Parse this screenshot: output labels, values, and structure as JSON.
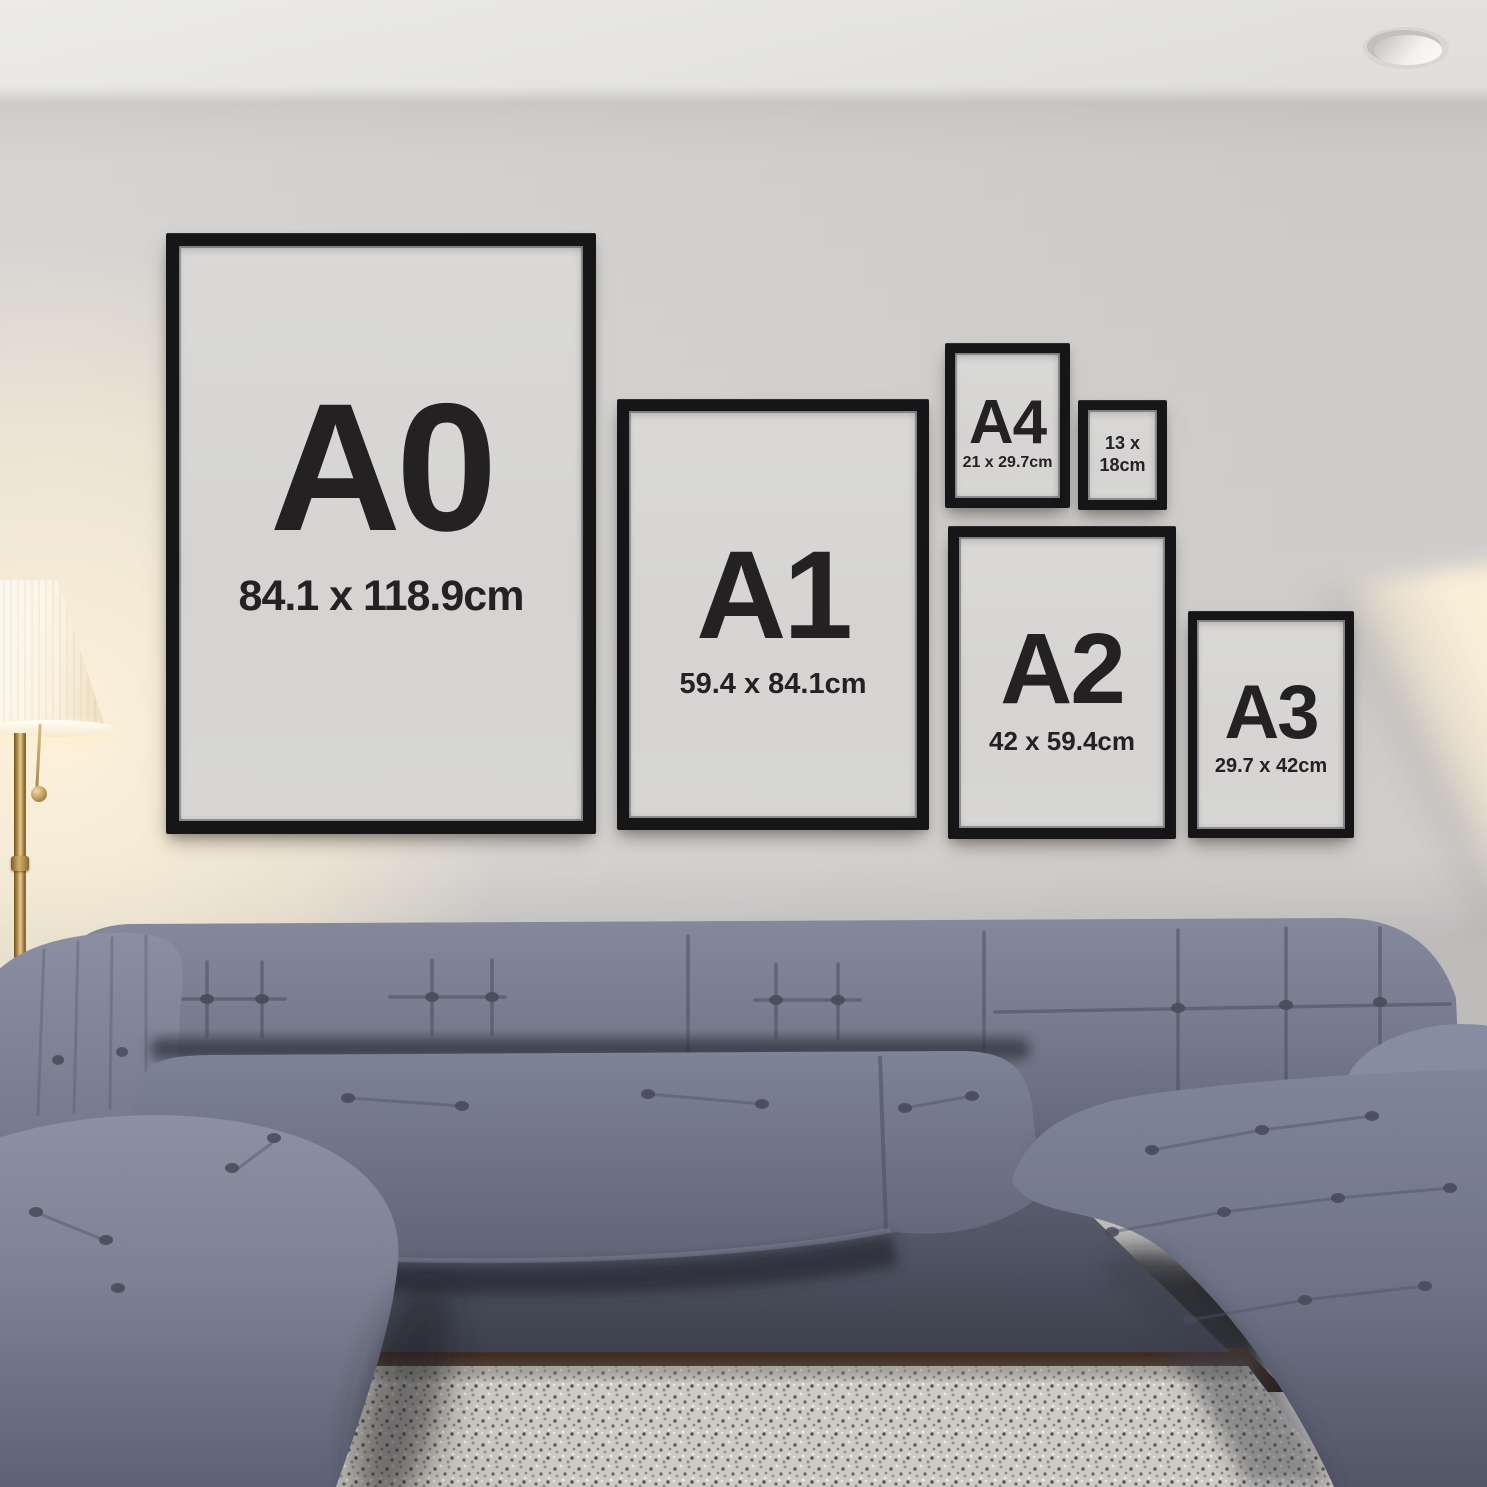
{
  "frames": [
    {
      "id": "a0",
      "label": "A0",
      "dimensions": "84.1 x 118.9cm"
    },
    {
      "id": "a1",
      "label": "A1",
      "dimensions": "59.4 x 84.1cm"
    },
    {
      "id": "a4",
      "label": "A4",
      "dimensions": "21 x 29.7cm"
    },
    {
      "id": "13x18",
      "dimensions_line1": "13 x",
      "dimensions_line2": "18cm"
    },
    {
      "id": "a2",
      "label": "A2",
      "dimensions": "42 x 59.4cm"
    },
    {
      "id": "a3",
      "label": "A3",
      "dimensions": "29.7 x 42cm"
    }
  ],
  "colors": {
    "frame_black": "#161618",
    "poster_paper": "#d7d6d4",
    "label_text": "#232122",
    "wall": "#d6d4d2",
    "ceiling": "#ebeae8",
    "sofa_fabric": "#747a8d",
    "rug": "#cdcac3",
    "lamp_glow": "#f9eed8",
    "lamp_brass": "#b2914f",
    "floor_wood": "#38281f"
  }
}
